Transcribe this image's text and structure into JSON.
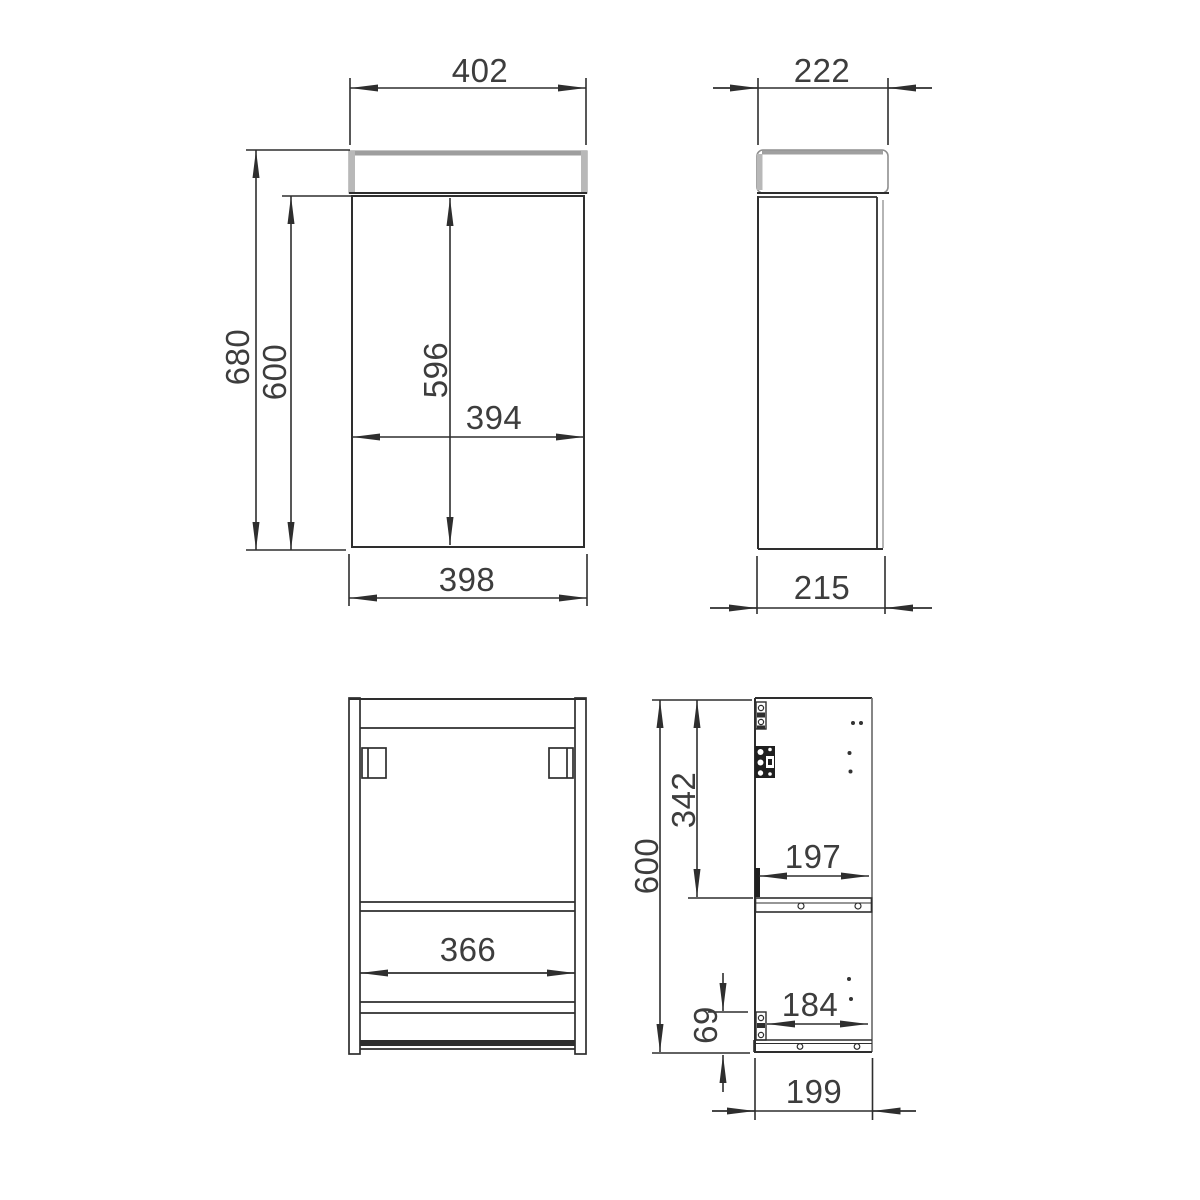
{
  "title": "Wall-hung cloakroom vanity unit – dimensioned technical drawing (mm)",
  "colors": {
    "background": "#ffffff",
    "line": "#2e2e2e",
    "edge_gray": "#a8a8a8",
    "text": "#3d3d3d"
  },
  "views": {
    "front": {
      "label": "front-view",
      "dimensions": {
        "overall_width": "402",
        "overall_height": "680",
        "carcase_height": "600",
        "door_height": "596",
        "door_width": "394",
        "carcase_width": "398"
      }
    },
    "side": {
      "label": "side-view",
      "dimensions": {
        "overall_depth": "222",
        "carcase_depth": "215"
      }
    },
    "rear": {
      "label": "rear-view",
      "dimensions": {
        "inner_width": "366"
      }
    },
    "section": {
      "label": "side-section-view",
      "dimensions": {
        "carcase_height": "600",
        "upper_compartment_height": "342",
        "inner_depth_top": "197",
        "inner_depth_bottom": "184",
        "bottom_rail_height": "69",
        "base_depth": "199"
      }
    }
  }
}
